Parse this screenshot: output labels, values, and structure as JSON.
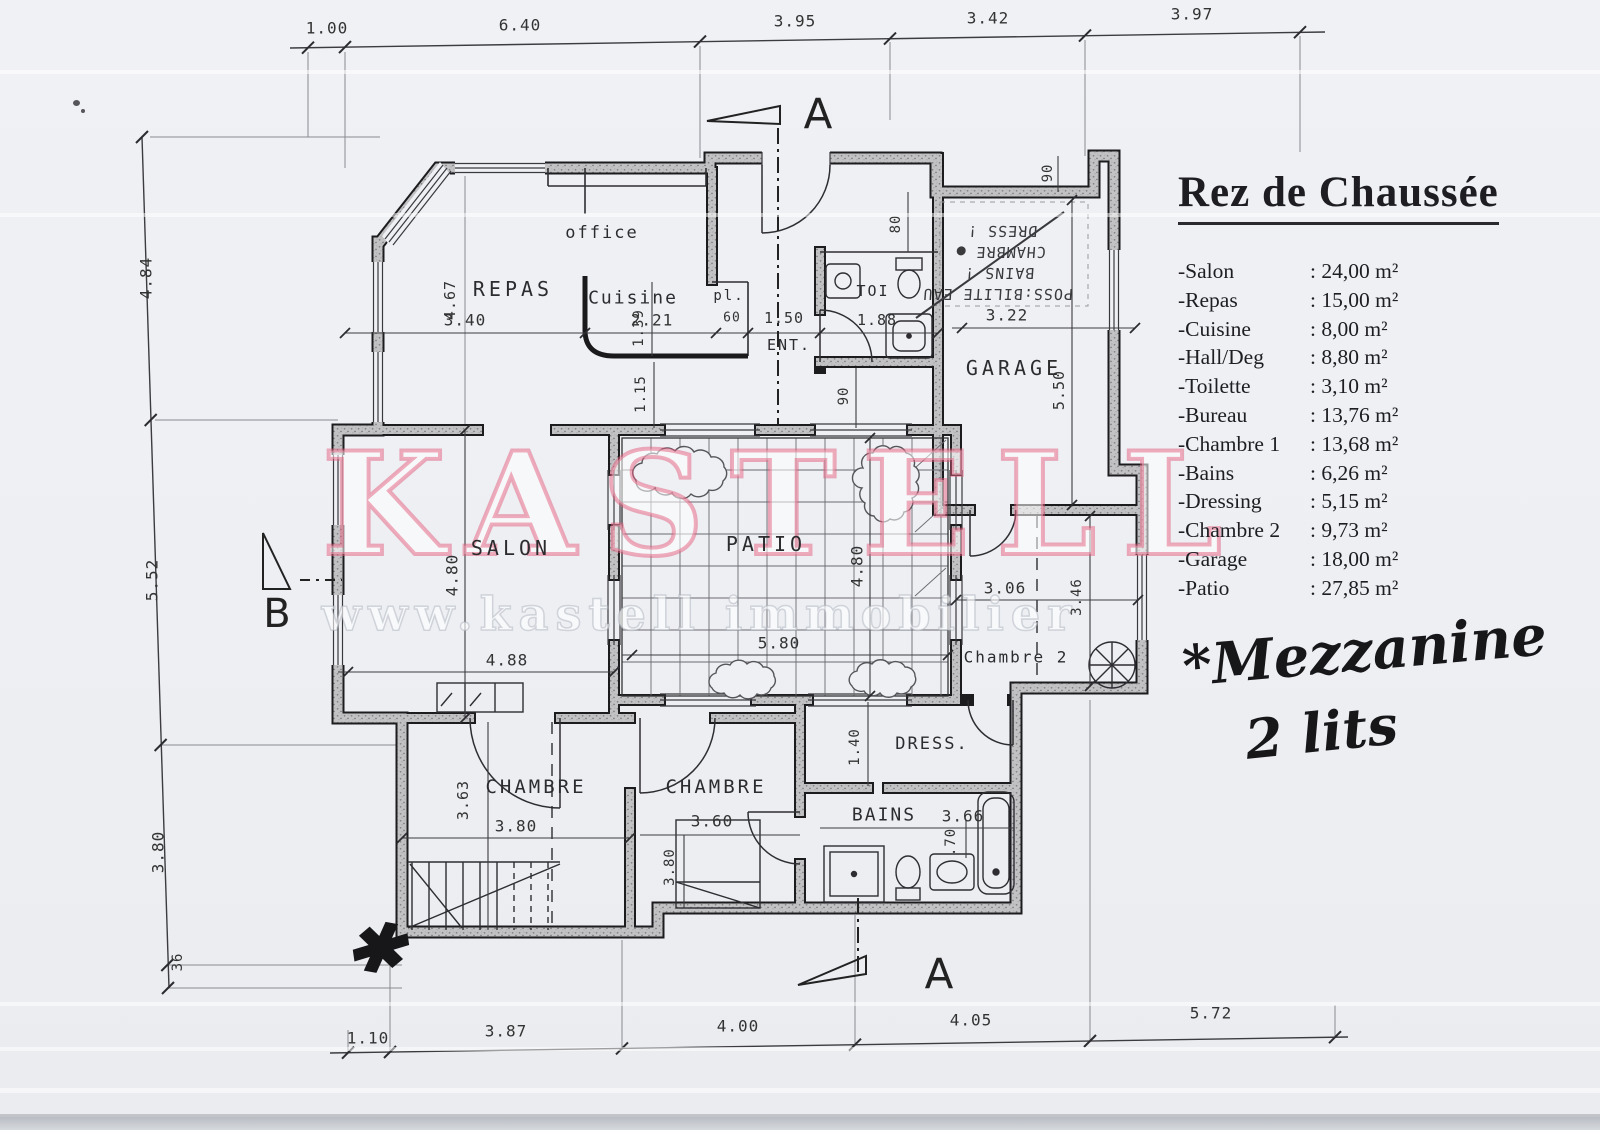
{
  "legend": {
    "title": "Rez de Chaussée",
    "rooms": [
      {
        "name": "-Salon",
        "area": ": 24,00 m²"
      },
      {
        "name": "-Repas",
        "area": ": 15,00 m²"
      },
      {
        "name": "-Cuisine",
        "area": ": 8,00 m²"
      },
      {
        "name": "-Hall/Deg",
        "area": ": 8,80 m²"
      },
      {
        "name": "-Toilette",
        "area": ": 3,10 m²"
      },
      {
        "name": "-Bureau",
        "area": ": 13,76 m²"
      },
      {
        "name": "-Chambre 1",
        "area": ": 13,68 m²"
      },
      {
        "name": "-Bains",
        "area": ": 6,26 m²"
      },
      {
        "name": "-Dressing",
        "area": ": 5,15 m²"
      },
      {
        "name": "-Chambre 2",
        "area": ": 9,73 m²"
      },
      {
        "name": "-Garage",
        "area": ": 18,00 m²"
      },
      {
        "name": "-Patio",
        "area": ": 27,85 m²"
      }
    ]
  },
  "watermark": {
    "brand": "KASTELL",
    "url_line": "www.kastell immobilier",
    "accent": "#e45d7e"
  },
  "notes": {
    "mezzanine_line1": "*Mezzanine",
    "mezzanine_line2": "2 lits",
    "asterisk": "✱"
  },
  "plan": {
    "room_labels": {
      "office": "office",
      "repas": "REPAS",
      "cuisine": "Cuisine",
      "placard": "pl.",
      "entree": "ENT.",
      "toilette": "TOI",
      "salon": "SALON",
      "patio": "PATIO",
      "garage": "GARAGE",
      "chambre2": "Chambre 2",
      "chambre_left": "CHAMBRE",
      "chambre_right": "CHAMBRE",
      "bains": "BAINS",
      "dress": "DRESS."
    },
    "flipped_note_lines": [
      "POSS:BILITE EAU",
      "BAINS !",
      "CHAMBRE ●",
      "DRESS !"
    ],
    "sections": {
      "a": "A",
      "b": "B"
    },
    "dims": {
      "top": [
        "1.00",
        "6.40",
        "3.95",
        "3.42",
        "3.97"
      ],
      "left": [
        "4.84",
        "5.52",
        "3.80",
        "36"
      ],
      "bottom": [
        "1.10",
        "3.87",
        "4.00",
        "4.05",
        "5.72"
      ],
      "repas_h": "3.40",
      "repas_v": "4.67",
      "cuisine_h": "2.21",
      "cuisine_v": "1.39",
      "placard_w": "60",
      "ent_w": "1.50",
      "toi_w": "1.88",
      "hall_v": "1.15",
      "hall_w": "90",
      "porch": "80",
      "garage_step": "90",
      "garage_h": "3.22",
      "garage_v": "5.50",
      "salon_v": "4.80",
      "salon_h": "4.88",
      "patio_h": "5.80",
      "patio_v": "4.80",
      "chambre2_h": "3.06",
      "chambre2_v": "3.46",
      "dress_v": "1.40",
      "bains_h": "3.66",
      "bains_v": ".70",
      "chambre_left_v": "3.63",
      "chambre_left_h": "3.80",
      "chambre_right_h": "3.60",
      "chambre_right_v": "3.80"
    }
  }
}
